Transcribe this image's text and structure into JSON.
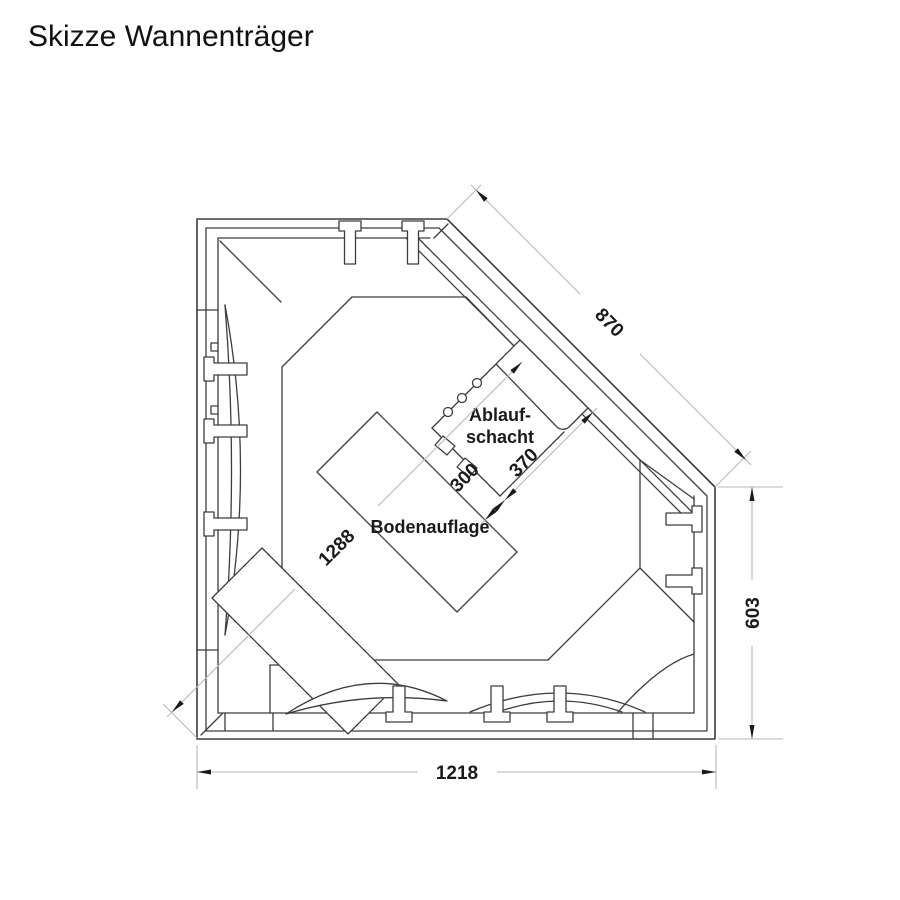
{
  "title": "Skizze Wannenträger",
  "drawing": {
    "labels": {
      "ablaufschacht_line1": "Ablauf-",
      "ablaufschacht_line2": "schacht",
      "bodenauflage": "Bodenauflage"
    },
    "dimensions": {
      "diagonal_rim": "870",
      "right_height": "603",
      "bottom_width": "1218",
      "overall_diagonal": "1288",
      "support_to_shaft": "300",
      "shaft_width": "370"
    },
    "colors": {
      "line": "#3d3d3d",
      "dimension_line": "#b8b8b8",
      "text": "#1a1a1a",
      "background": "#ffffff"
    }
  }
}
